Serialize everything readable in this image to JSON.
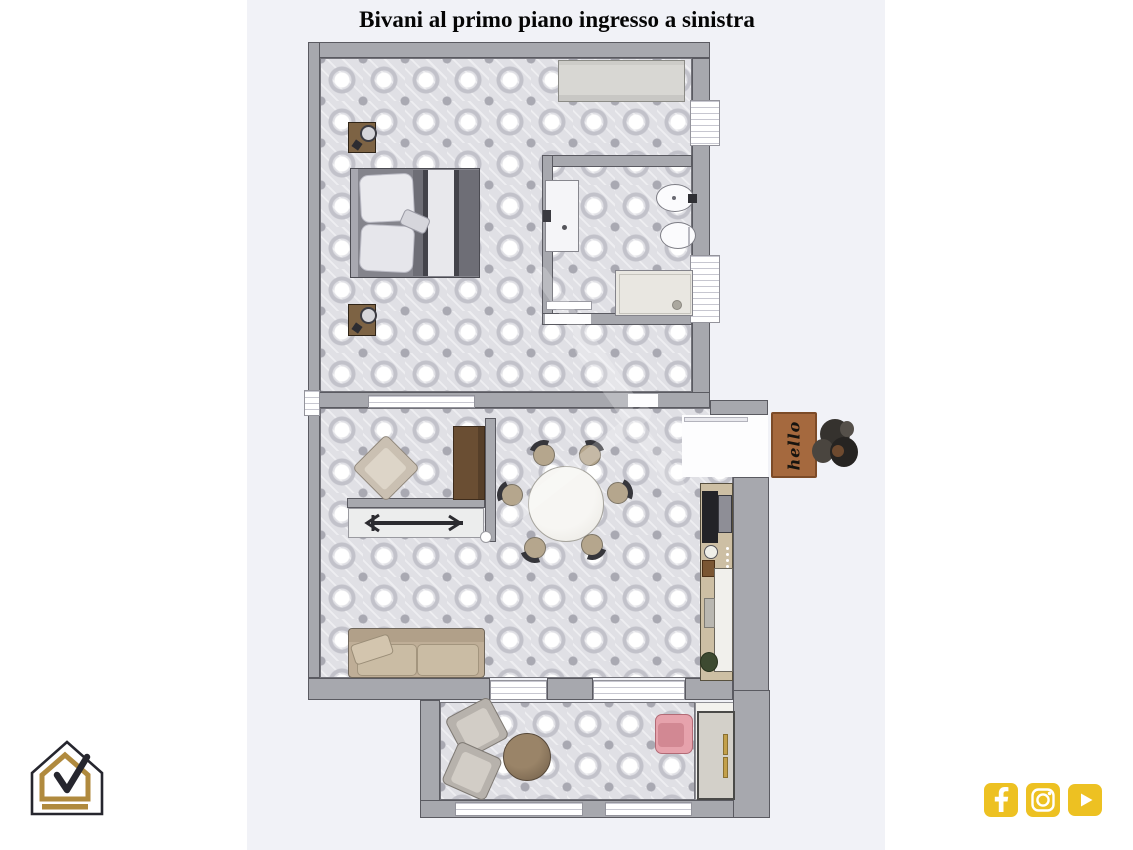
{
  "title": {
    "text": "Bivani al primo piano ingresso a sinistra"
  },
  "floorplan": {
    "doormat_text": "hello",
    "rooms_visible": [
      "bedroom",
      "bathroom",
      "hallway",
      "living-dining",
      "kitchenette",
      "entry",
      "veranda"
    ],
    "fixtures": [
      "double-bed",
      "nightstands",
      "wardrobe",
      "sink-vanity",
      "bidet",
      "toilet",
      "shower-tray",
      "accent-armchair",
      "tall-cabinet",
      "console-with-coat-rack",
      "round-dining-table",
      "six-dining-chairs",
      "kitchenette-counter-tv",
      "sofa",
      "entry-doormat",
      "plant",
      "two-lounge-chairs",
      "round-pouf",
      "pink-armchair",
      "sideboard"
    ]
  },
  "colors": {
    "page_bg": "#ffffff",
    "canvas_bg": "#f1f2f7",
    "wall": "#a7a8ae",
    "wall_outline": "#5a5a61",
    "tile_base": "#e0e0e5",
    "doormat_brown": "#a5693e",
    "pink_chair": "#e6a2ac",
    "sofa_beige": "#bfae97",
    "social_gold": "#edc122",
    "logo_gold": "#b08a3e",
    "logo_dark": "#26262e"
  },
  "branding": {
    "logo": "house-with-checkmark"
  },
  "social": {
    "icons": [
      {
        "name": "facebook"
      },
      {
        "name": "instagram"
      },
      {
        "name": "youtube"
      }
    ]
  }
}
